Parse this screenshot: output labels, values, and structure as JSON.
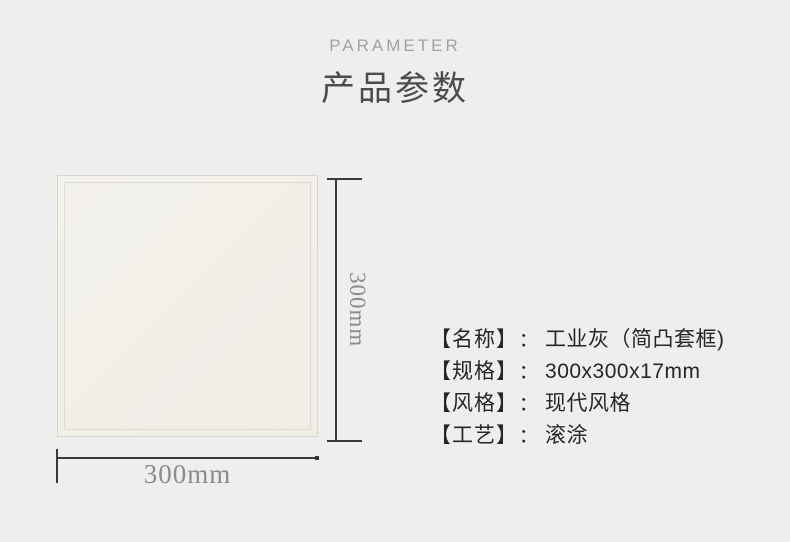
{
  "header": {
    "eyebrow": "PARAMETER",
    "title": "产品参数"
  },
  "product_figure": {
    "tile_description": "plain cream-white tile swatch",
    "height_dimension_label": "300mm",
    "width_dimension_label": "300mm"
  },
  "specs": {
    "separator": "：",
    "rows": [
      {
        "label": "【名称】",
        "value": "工业灰（简凸套框)"
      },
      {
        "label": "【规格】",
        "value": "300x300x17mm"
      },
      {
        "label": "【风格】",
        "value": "现代风格"
      },
      {
        "label": "【工艺】",
        "value": "滚涂"
      }
    ]
  },
  "colors": {
    "background": "#eeeeee",
    "tile": "#f1efe8",
    "tile_border": "#d9d6ca",
    "heading_text": "#4c4c4c",
    "eyebrow_text": "#a2a2a2",
    "dimension_line": "#3a3a3a",
    "dimension_text": "#8b8b8b",
    "spec_text": "#262626"
  }
}
